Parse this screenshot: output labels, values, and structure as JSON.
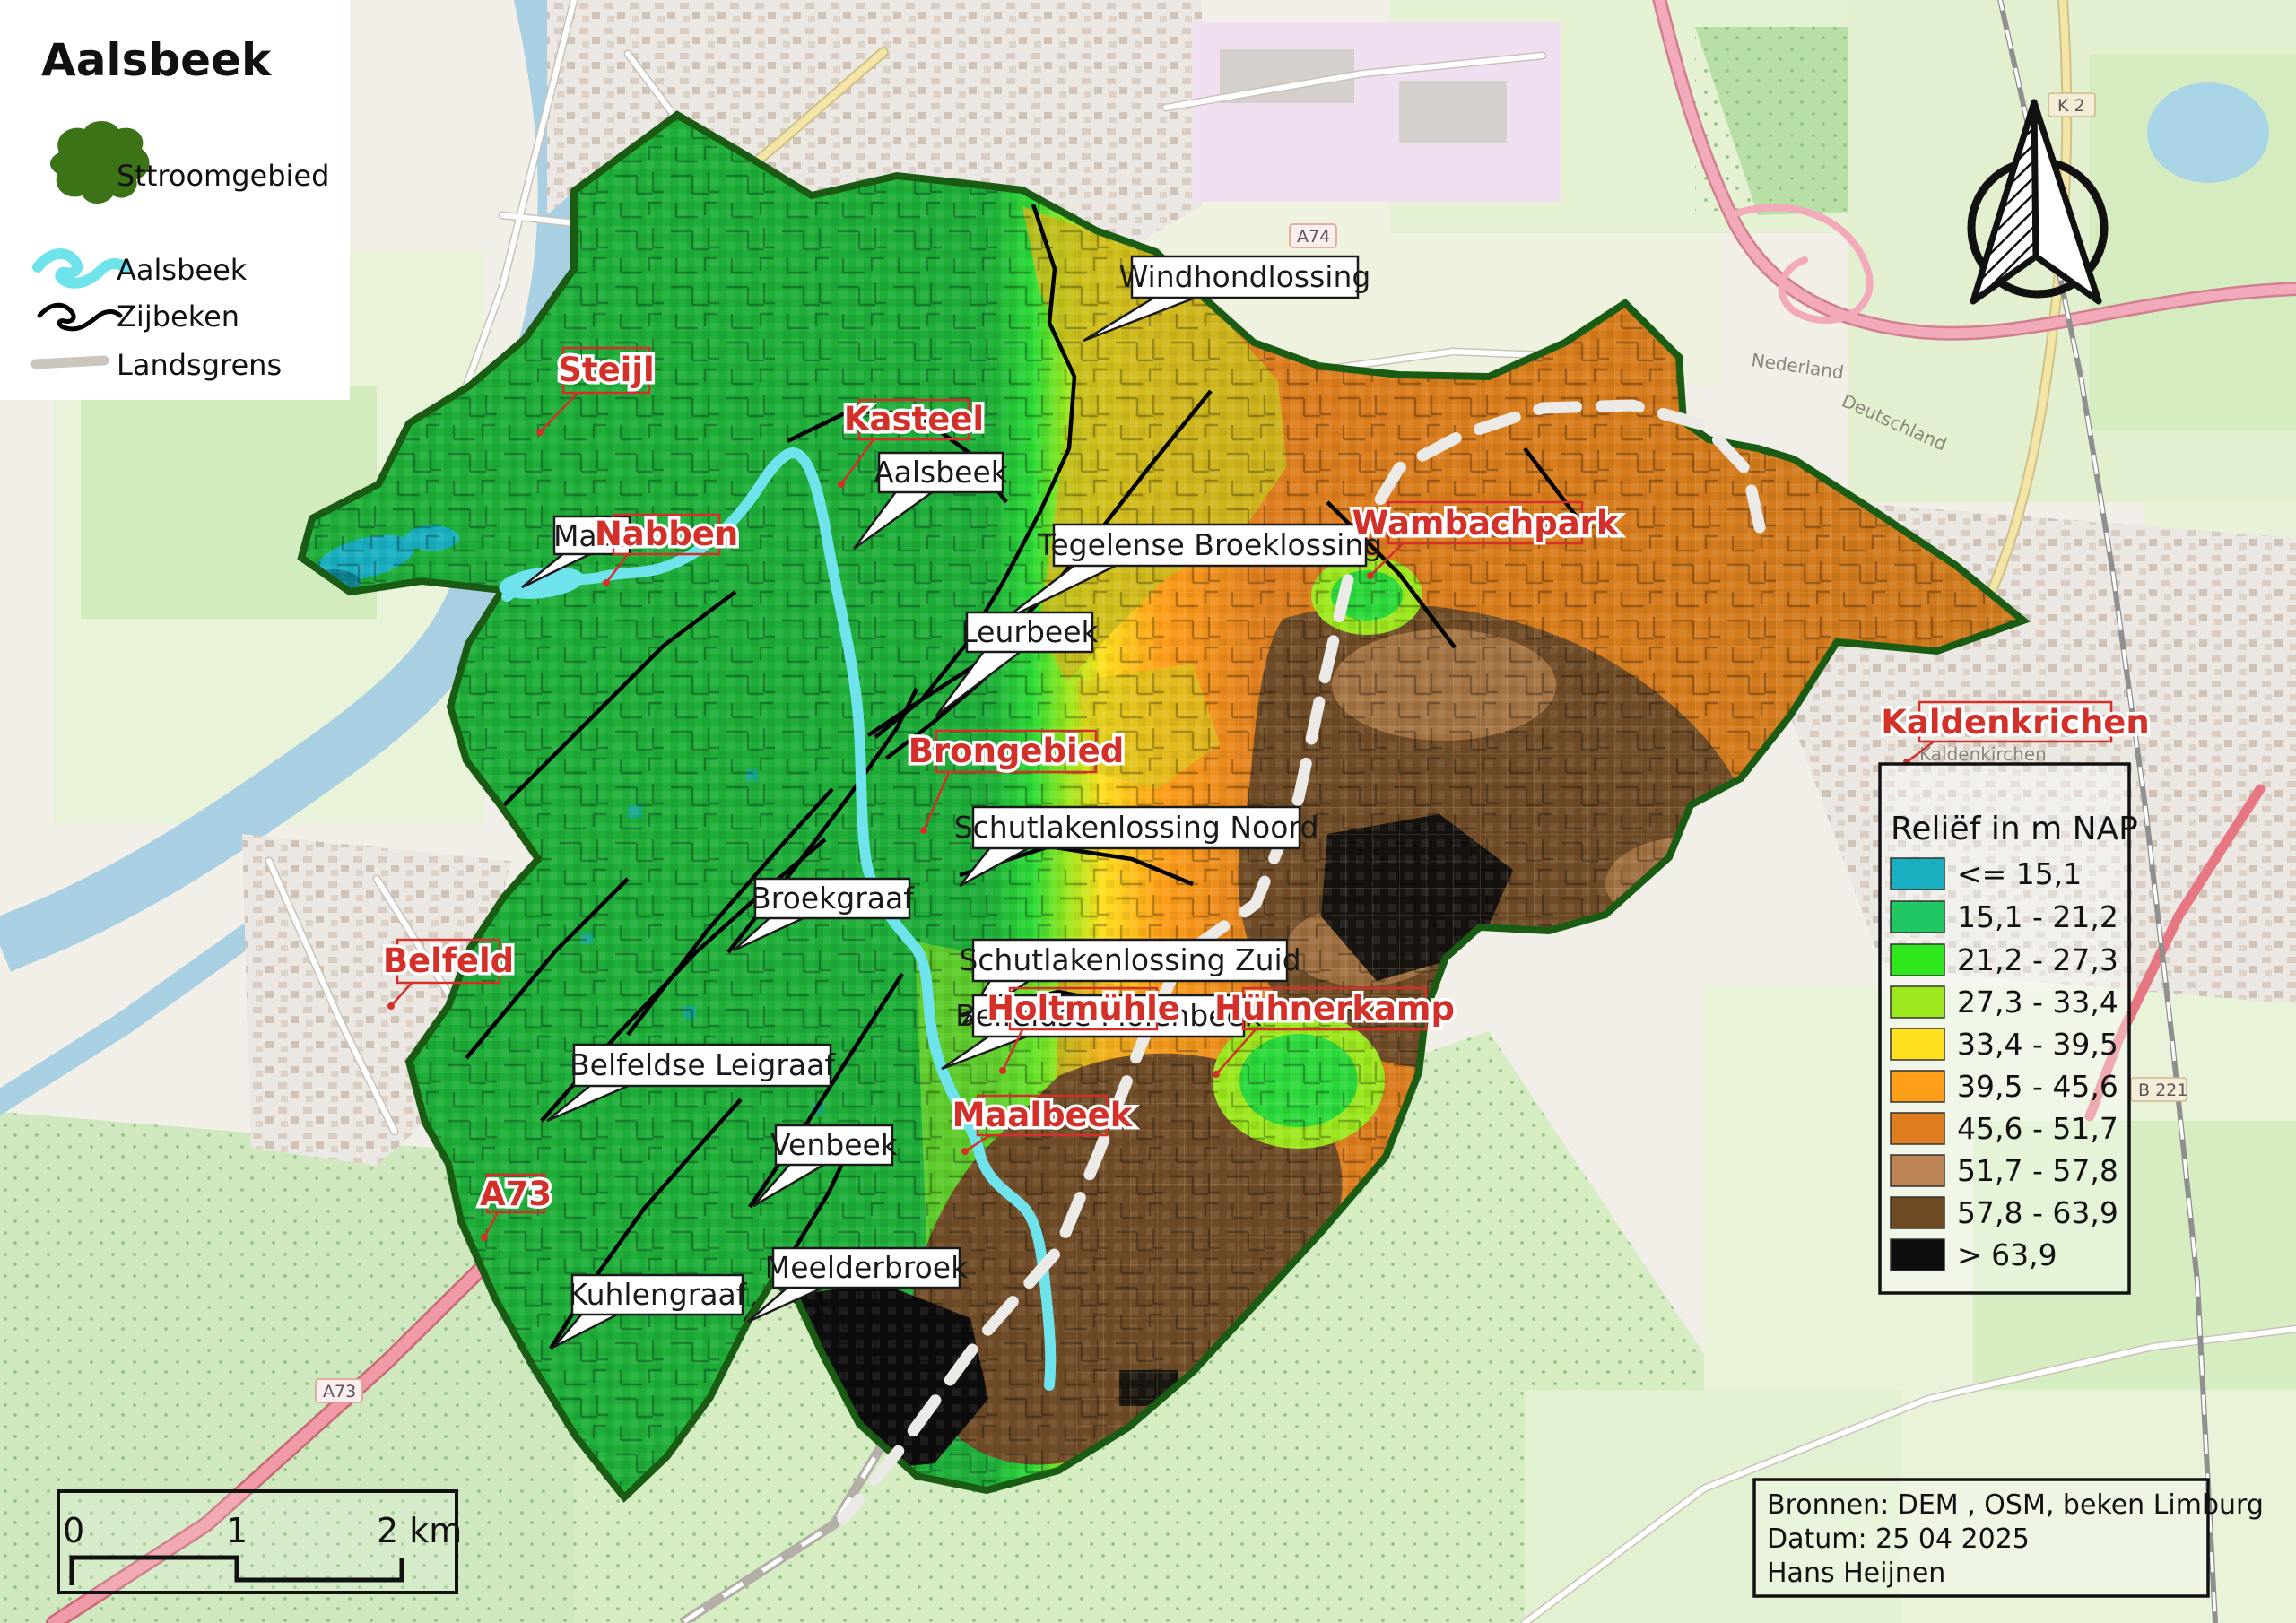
{
  "title": "Aalsbeek",
  "legend": {
    "items": [
      {
        "label": "Sttroomgebied"
      },
      {
        "label": "Aalsbeek"
      },
      {
        "label": "Zijbeken"
      },
      {
        "label": "Landsgrens"
      }
    ]
  },
  "relief_legend": {
    "title": "Reliëf in m NAP",
    "classes": [
      {
        "label": "<= 15,1",
        "color": "#1aafc0"
      },
      {
        "label": "15,1 - 21,2",
        "color": "#20c763"
      },
      {
        "label": "21,2 - 27,3",
        "color": "#2de71c"
      },
      {
        "label": "27,3 - 33,4",
        "color": "#9ce71d"
      },
      {
        "label": "33,4 - 39,5",
        "color": "#fee01e"
      },
      {
        "label": "39,5 - 45,6",
        "color": "#fe9e19"
      },
      {
        "label": "45,6 - 51,7",
        "color": "#de7e1f"
      },
      {
        "label": "51,7 - 57,8",
        "color": "#bc8455"
      },
      {
        "label": "57,8 - 63,9",
        "color": "#6e4a23"
      },
      {
        "label": "> 63,9",
        "color": "#0d0d0d"
      }
    ]
  },
  "scalebar": {
    "zero": "0",
    "one": "1",
    "two": "2 km"
  },
  "credits": {
    "line1": "Bronnen: DEM , OSM, beken Limburg",
    "line2": "Datum: 25 04 2025",
    "line3": "Hans Heijnen"
  },
  "labels": {
    "windhondlossing": "Windhondlossing",
    "aalsbeek_stream": "Aalsbeek",
    "tegelense": "Tegelense Broeklossing",
    "leurbeek": "Leurbeek",
    "schutlaken_noord": "Schutlakenlossing Noord",
    "schutlaken_zuid": "Schutlakenlossing Zuid",
    "broekgraaf": "Broekgraaf",
    "belfeldse_leigraaf": "Belfeldse Leigraaf",
    "venbeek": "Venbeek",
    "belfeldse_molenbeek": "Belfeldse Molenbeek",
    "kuhlengraaf": "Kuhlengraaf",
    "meelderbroek": "Meelderbroek",
    "maas": "Maas"
  },
  "places": {
    "steijl": "Steijl",
    "kasteel": "Kasteel",
    "nabben": "Nabben",
    "wambachpark": "Wambachpark",
    "brongebied": "Brongebied",
    "holtmuhle": "Holtmühle",
    "huhnerkamp": "Hühnerkamp",
    "belfeld": "Belfeld",
    "a73": "A73",
    "maalbeek": "Maalbeek",
    "kaldenkrichen": "Kaldenkrichen"
  },
  "shields": {
    "a74": "A74",
    "a73": "A73",
    "b221": "B 221",
    "k2": "K 2"
  },
  "osm": {
    "kaldenkirchen": "Kaldenkirchen",
    "nederland": "Nederland",
    "deutschland": "Deutschland"
  },
  "colors": {
    "aalsbeek": "#6fe3ec",
    "zijbeken": "#000000",
    "landsgrens_legend": "#cbc5bd",
    "stroomgebied": "#3d7317",
    "catchment_border": "#1a5c14",
    "landsgrens_line": "#eceae6",
    "place_red": "#d3302a"
  }
}
